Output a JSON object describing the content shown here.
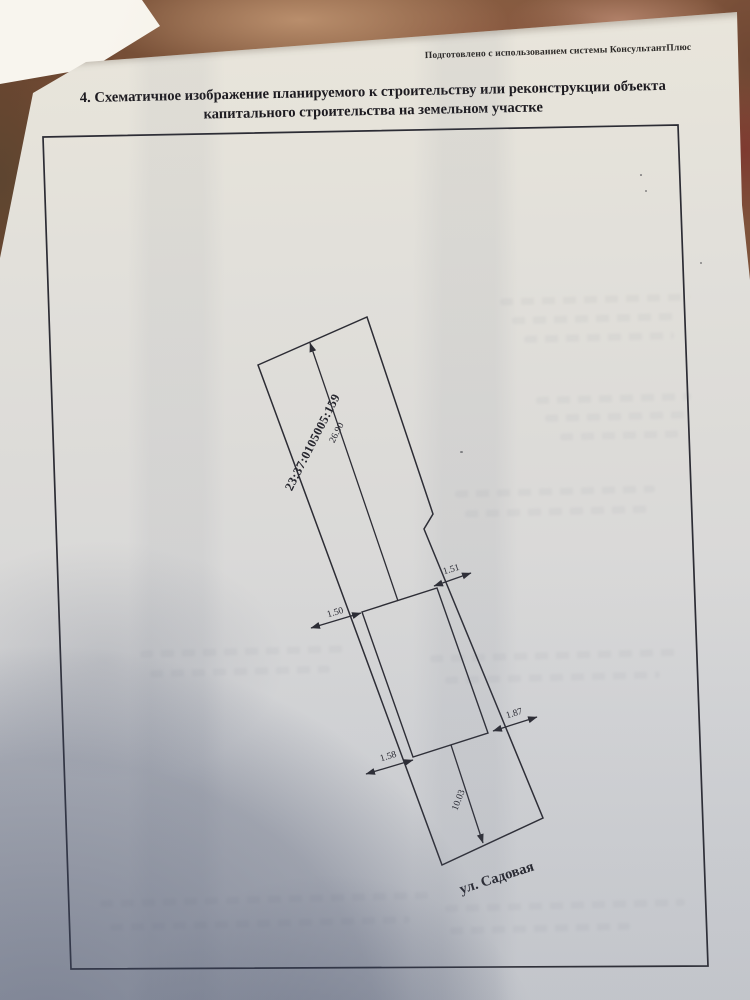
{
  "watermark": "Подготовлено с использованием системы КонсультантПлюс",
  "title": {
    "line1": "4. Схематичное изображение планируемого к строительству или реконструкции объекта",
    "line2": "капитального строительства на земельном участке"
  },
  "site_plan": {
    "cadastral_number": "23:37:0105005:159",
    "street_label": "ул. Садовая",
    "dimensions": {
      "rear_distance_m": "26.90",
      "front_distance_m": "10.03",
      "gap_upper_left_m": "1.50",
      "gap_upper_right_m": "1.51",
      "gap_lower_left_m": "1.58",
      "gap_lower_right_m": "1.87"
    }
  },
  "colors": {
    "ink": "#2c2c34",
    "paper": "#e2e1dd",
    "table_wood": "#7a5138",
    "shadow_tint": "#38425e"
  }
}
